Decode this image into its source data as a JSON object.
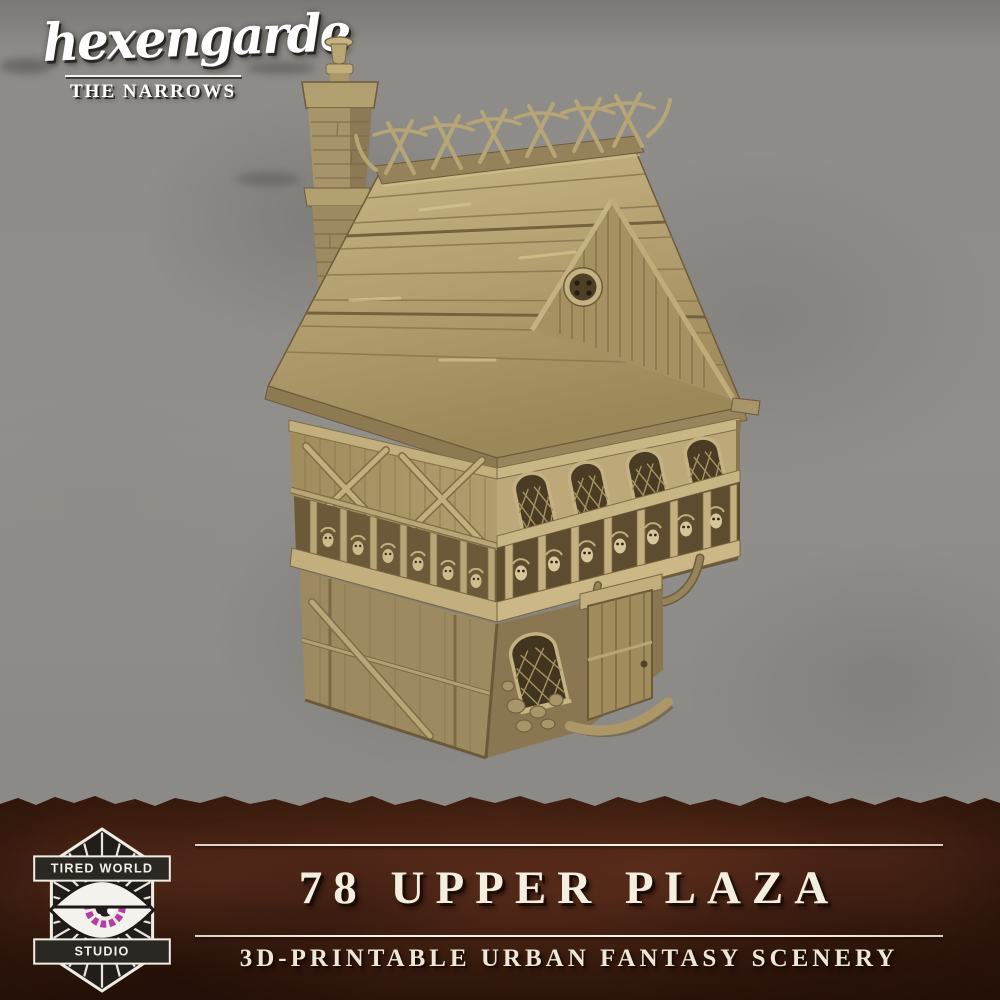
{
  "brand": {
    "name": "hexengarde",
    "series": "THE NARROWS"
  },
  "banner": {
    "title": "78 UPPER PLAZA",
    "subtitle": "3D-PRINTABLE URBAN FANTASY SCENERY"
  },
  "studio_badge": {
    "line_top": "TIRED WORLD",
    "line_bottom": "STUDIO",
    "icon": "all-seeing-eye-icon"
  },
  "artwork": {
    "type": "3d-render",
    "subject": "timber-framed fantasy townhouse miniature",
    "features": [
      "brick chimney with pot",
      "shingle roof",
      "crossed ridge finials",
      "round gable window",
      "arched lattice windows",
      "skull frieze",
      "jettied upper storey",
      "plank door",
      "stone rubble base"
    ]
  },
  "colors": {
    "background_gray": "#8e8d89",
    "background_gray_dark": "#797874",
    "banner_brown": "#4e2717",
    "banner_brown_dark": "#2b1209",
    "text_cream": "#f4eedf",
    "text_white": "#ffffff",
    "house_tan_light": "#c9b685",
    "house_tan_mid": "#ab9668",
    "house_tan_dark": "#7c6945",
    "badge_dark": "#262220",
    "eye_purple": "#b53da6"
  }
}
